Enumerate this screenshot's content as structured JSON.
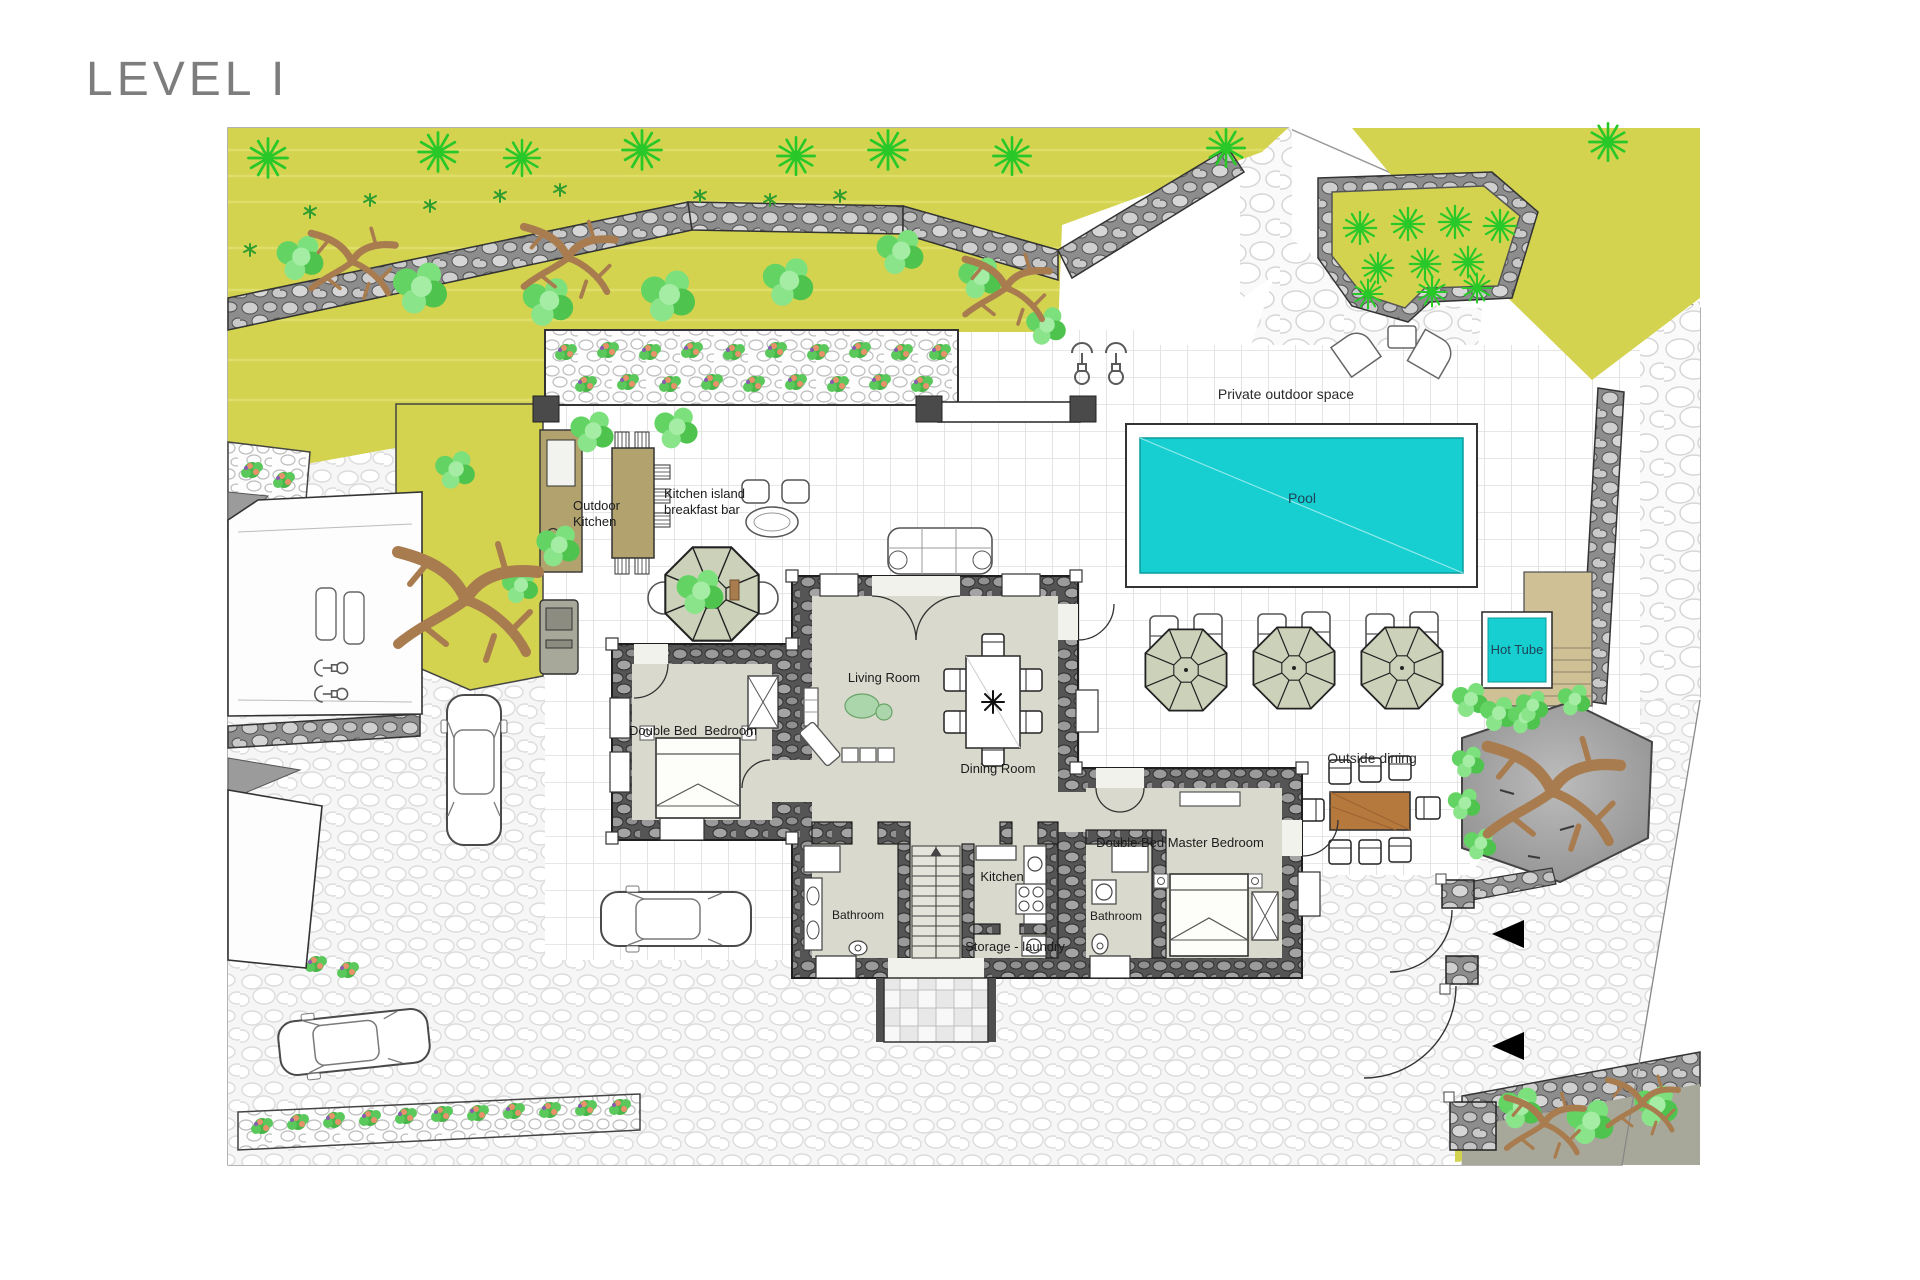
{
  "page": {
    "title": "LEVEL I"
  },
  "labels": {
    "private_outdoor_space": "Private outdoor space",
    "pool": "Pool",
    "hot_tube": "Hot Tube",
    "outside_dining": "Outside dining",
    "outdoor_kitchen_line1": "Outdoor",
    "outdoor_kitchen_line2": "Kitchen",
    "kitchen_island_line1": "Kitchen island",
    "kitchen_island_line2": "breakfast bar",
    "living_room": "Living Room",
    "dining_room": "Dining Room",
    "double_bedroom": "Double Bed  Bedroom",
    "master_bedroom": "Double Bed Master Bedroom",
    "kitchen": "Kitchen",
    "bathroom_left": "Bathroom",
    "bathroom_right": "Bathroom",
    "storage_laundry": "Storage - laundry"
  },
  "colors": {
    "pool_water": "#17cfd1",
    "lawn": "#d3d350",
    "house_wall": "#585858",
    "interior_floor": "#d9d9cd",
    "deck_tan": "#cfc096",
    "counter_tan": "#b2a36e",
    "dining_table": "#b5793d",
    "tree_green": "#2ecc2e",
    "title_gray": "#7d7d7d"
  }
}
